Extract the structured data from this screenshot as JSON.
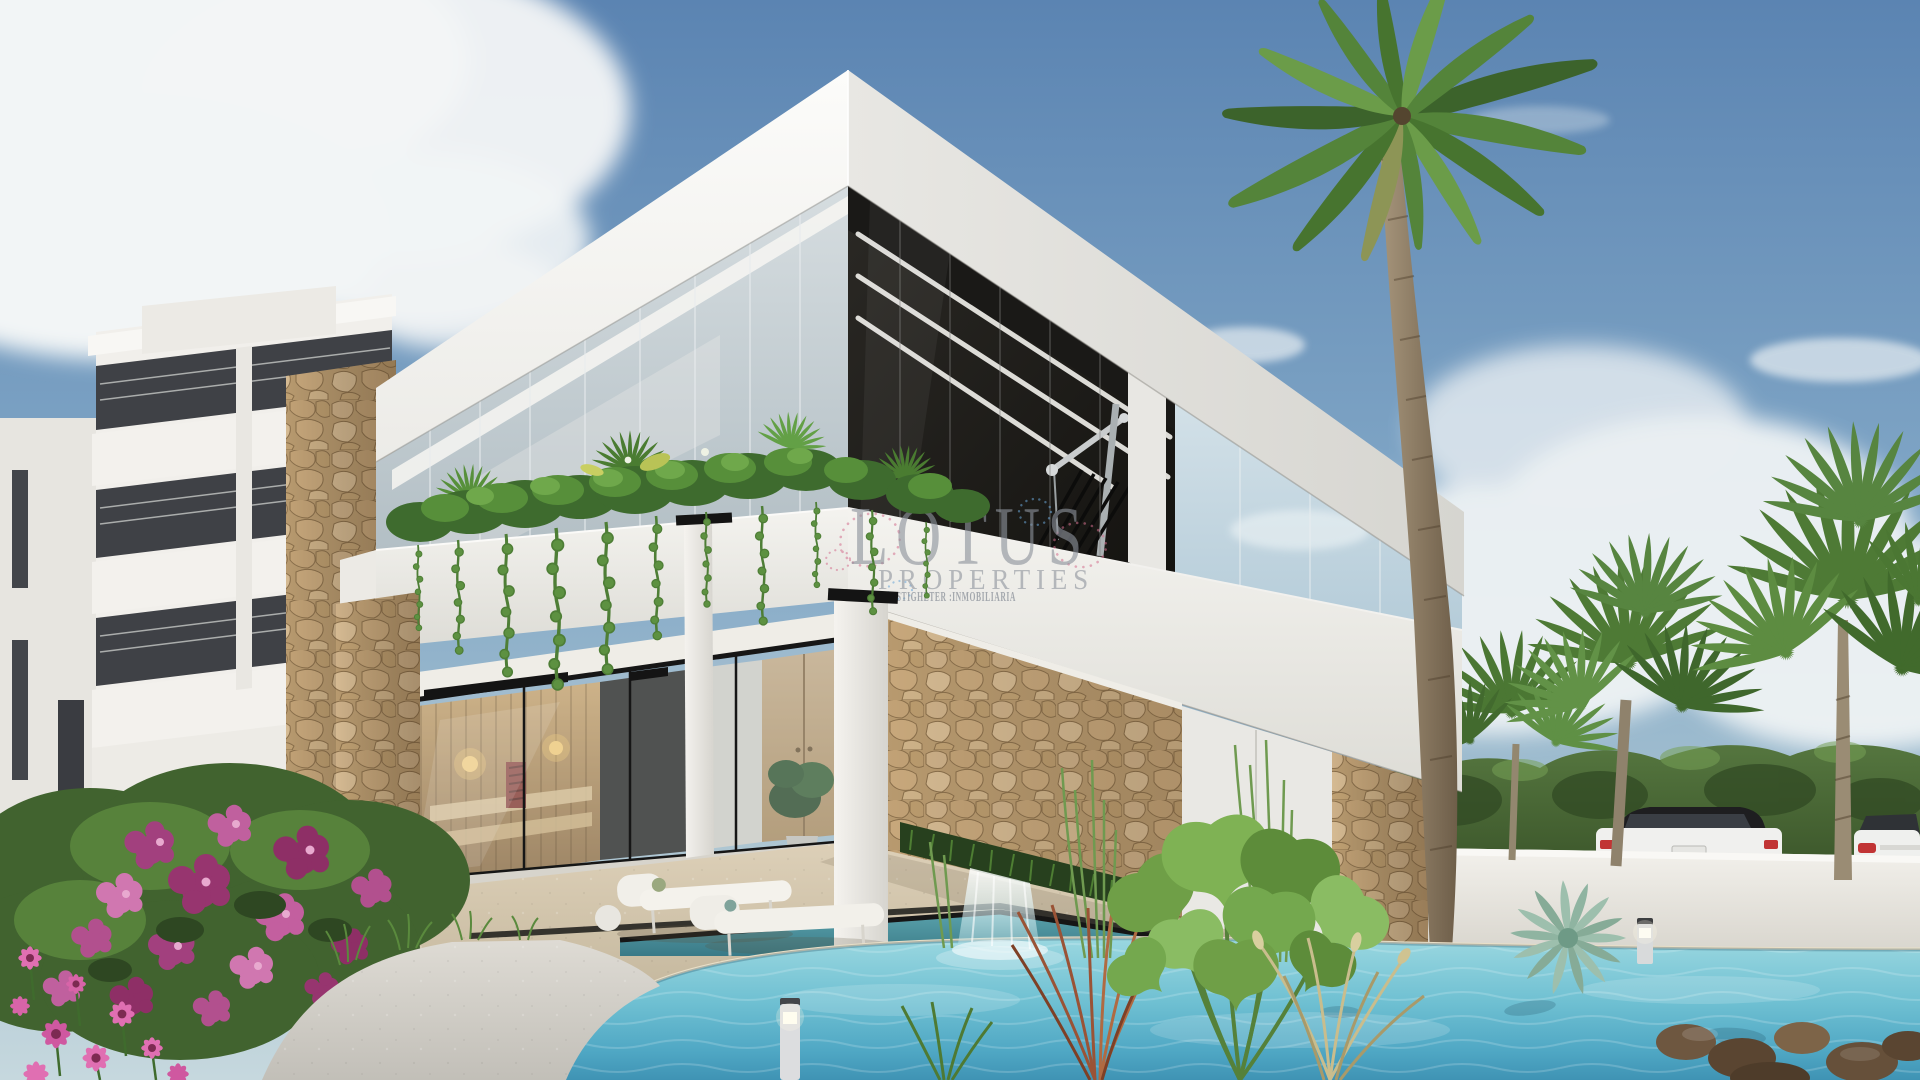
{
  "watermark": {
    "brand": "LOTUS",
    "subtitle": "PROPERTIES",
    "tagline": "FASTIGHETER :INMOBILIARIA"
  },
  "scene": {
    "type": "architectural-render",
    "time_of_day": "daylight",
    "elements": [
      "blue sky with white clouds",
      "white apartment building with recessed balconies and stone pier",
      "two-storey modern white villa with angular roof slabs",
      "upper-floor gym behind dark glazing with LED strip lighting",
      "balcony planter with hanging ivy and ferns",
      "glass sauna cabin with warm wooden interior",
      "natural stone feature walls with grass planter and waterfall",
      "turquoise swimming pool with aquatic plants and rocks",
      "tall royal palm tree",
      "fan palm trees above white perimeter wall",
      "two parked white cars behind the wall",
      "white lounge chairs on travertine terrace",
      "magenta flowering shrubs and pink daisies",
      "bollard lights"
    ]
  },
  "palette": {
    "sky_top": "#5b84b2",
    "sky_horizon": "#c6d8de",
    "cloud": "#f2f5f6",
    "villa_white": "#f7f6f3",
    "villa_shade": "#e2e1dc",
    "glass_dark": "#23211e",
    "led_strip": "#f4f3ef",
    "stone": "#c2a277",
    "stone_joint": "#8a6f4b",
    "sauna_wood": "#c79a63",
    "sauna_glow": "#ffd27a",
    "pool_light": "#9fdbe3",
    "pool_deep": "#3f93b4",
    "deck": "#d5c7ae",
    "pavement": "#d5d2cb",
    "foliage_dark": "#3a5429",
    "foliage_light": "#6fa84b",
    "flower_magenta": "#a2407e",
    "flower_pink": "#e06fb2",
    "perimeter_wall": "#edebe6",
    "car_body": "#f0f0ee",
    "car_roof": "#1e1e20",
    "taillight": "#c13434",
    "watermark_gray": "#8d939c"
  }
}
